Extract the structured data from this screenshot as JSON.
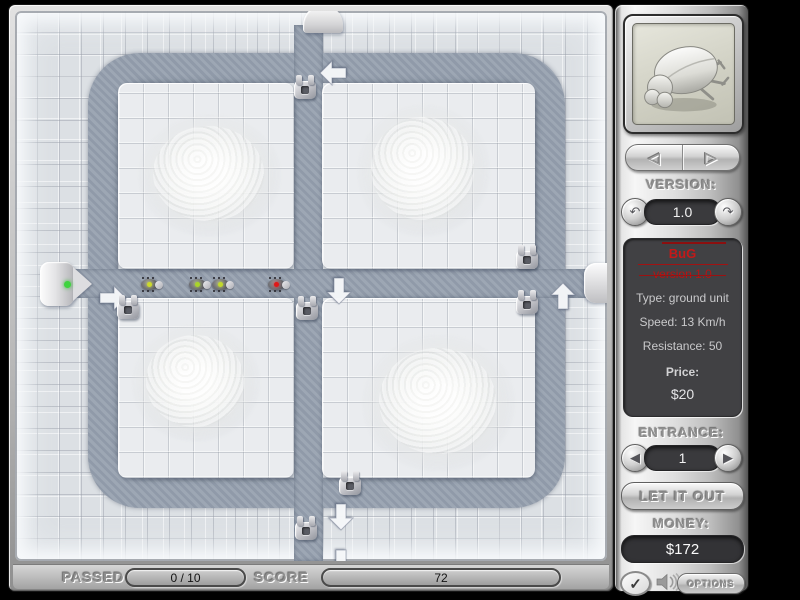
{
  "colors": {
    "path": "#96a0ae",
    "tile_base": "#dce0e4",
    "tile_block": "#eaecef",
    "accent_red": "#c51818",
    "entrance_green": "#3fd43f"
  },
  "board": {
    "arrows": [
      {
        "x": 305,
        "y": 48,
        "dir": "left"
      },
      {
        "x": 85,
        "y": 273,
        "dir": "right"
      },
      {
        "x": 311,
        "y": 266,
        "dir": "down"
      },
      {
        "x": 535,
        "y": 271,
        "dir": "up"
      },
      {
        "x": 313,
        "y": 492,
        "dir": "down"
      },
      {
        "x": 313,
        "y": 538,
        "dir": "down"
      }
    ],
    "towers": [
      {
        "x": 290,
        "y": 77
      },
      {
        "x": 113,
        "y": 297
      },
      {
        "x": 292,
        "y": 298
      },
      {
        "x": 512,
        "y": 247
      },
      {
        "x": 512,
        "y": 292
      },
      {
        "x": 335,
        "y": 473
      },
      {
        "x": 291,
        "y": 518
      }
    ],
    "bugs": [
      {
        "x": 137,
        "y": 273,
        "color": "#ccd92c"
      },
      {
        "x": 185,
        "y": 273,
        "color": "#a9d42a"
      },
      {
        "x": 208,
        "y": 273,
        "color": "#c2d82c"
      },
      {
        "x": 264,
        "y": 273,
        "color": "#e01818"
      }
    ]
  },
  "sidebar": {
    "preview_icon": "beetle-icon",
    "nav": {
      "prev_icon": "◁",
      "next_icon": "▷"
    },
    "version": {
      "label": "VERSION:",
      "value": "1.0",
      "down_icon": "↶",
      "up_icon": "↷"
    },
    "info": {
      "name": "BuG",
      "version": "version 1.0",
      "type": "Type: ground unit",
      "speed": "Speed: 13 Km/h",
      "resistance": "Resistance: 50",
      "price_label": "Price:",
      "price": "$20"
    },
    "entrance": {
      "label": "ENTRANCE:",
      "value": "1",
      "prev_icon": "◀",
      "next_icon": "▶"
    },
    "release_button": "LET IT OUT",
    "money": {
      "label": "MONEY:",
      "value": "$172"
    },
    "check_icon": "✓",
    "sound_icon": "speaker-icon",
    "options_button": "OPTIONS"
  },
  "statusbar": {
    "passed_label": "PASSED",
    "passed_value": "0 / 10",
    "score_label": "SCORE",
    "score_value": "72"
  }
}
